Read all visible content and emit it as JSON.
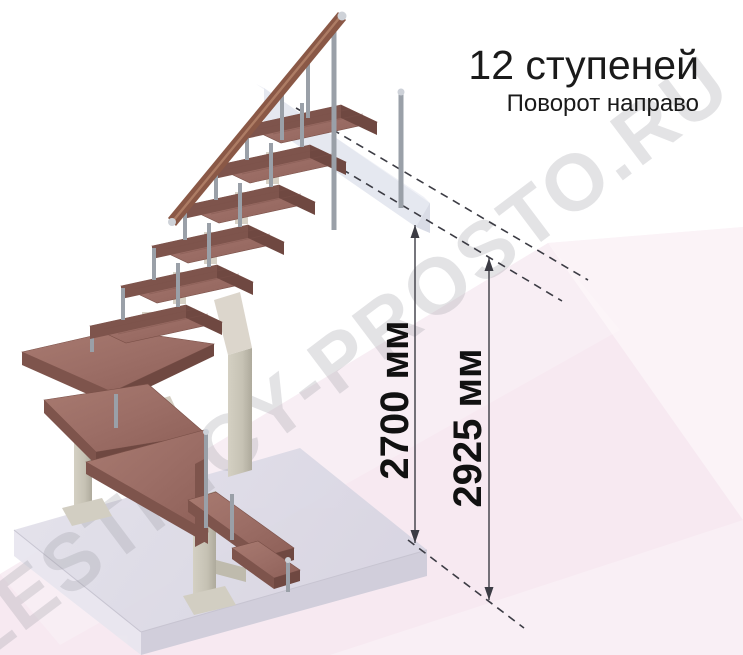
{
  "header": {
    "steps_count": "12 ступеней",
    "turn_direction": "Поворот направо"
  },
  "dimensions": {
    "opening_height": {
      "value": "2700",
      "unit": "мм",
      "label": "2700 мм"
    },
    "total_height": {
      "value": "2925",
      "unit": "мм",
      "label": "2925 мм"
    }
  },
  "watermark": {
    "text": "LESTNICY-PROSTO.RU"
  },
  "illustration": {
    "subject": "modular staircase, 12 steps, right turn, isometric view",
    "parts": [
      "straight-flight-treads",
      "winder-treads",
      "bottom-flight-treads",
      "central-support-columns",
      "chrome-balusters",
      "wooden-handrail",
      "upper-floor-landing-beam",
      "base-floor-slab",
      "dimension-line-2700",
      "dimension-line-2925",
      "dashed-extension-lines"
    ]
  },
  "colors": {
    "background": "#ffffff",
    "floor_pink": "#f7e9f1",
    "tread_wood_top": "#9c6e66",
    "tread_wood_edge": "#7e544c",
    "tread_wood_side": "#6f4841",
    "handrail_wood": "#8a5846",
    "metal_chrome": "#a9aeb6",
    "support_beige": "#d6d0c4",
    "slab_gray": "#dcdae6",
    "landing_gray": "#e2e5ee",
    "dimension_line": "#3c3c44",
    "text_black": "#1a1a1a",
    "watermark_gray": "#97979f"
  }
}
